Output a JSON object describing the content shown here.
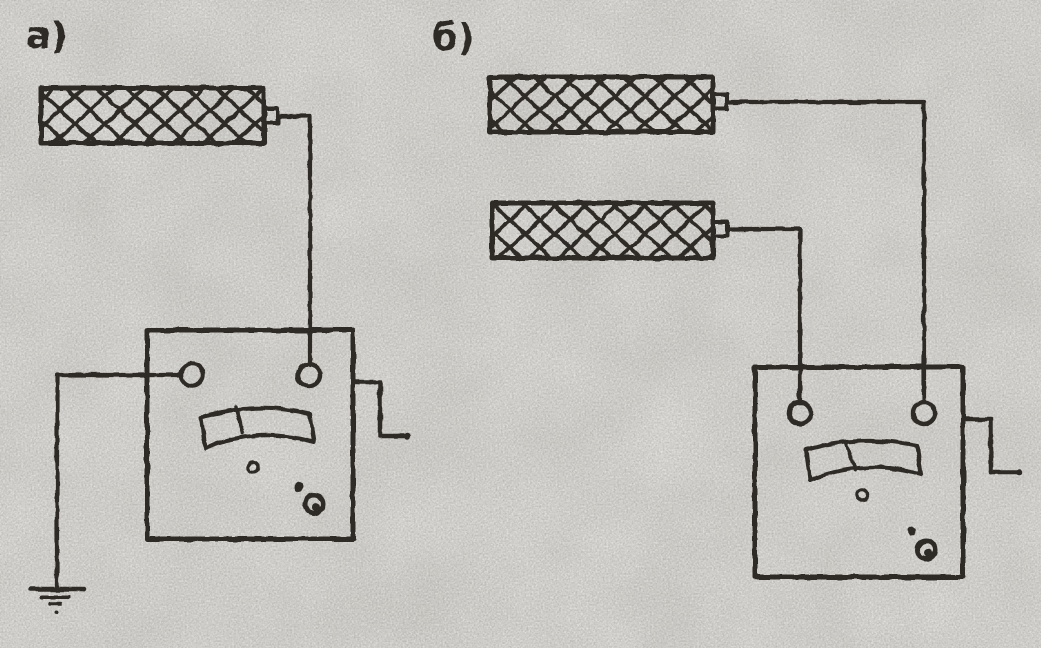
{
  "figure": {
    "colors": {
      "paper": "#d7d5d0",
      "ink": "#2e2b26"
    },
    "panel_a": {
      "label": "а)",
      "components": [
        "hatched-sample",
        "megohmmeter",
        "crank-handle",
        "earth-ground"
      ]
    },
    "panel_b": {
      "label": "б)",
      "components": [
        "hatched-sample-top",
        "hatched-sample-bottom",
        "megohmmeter",
        "crank-handle"
      ]
    }
  }
}
